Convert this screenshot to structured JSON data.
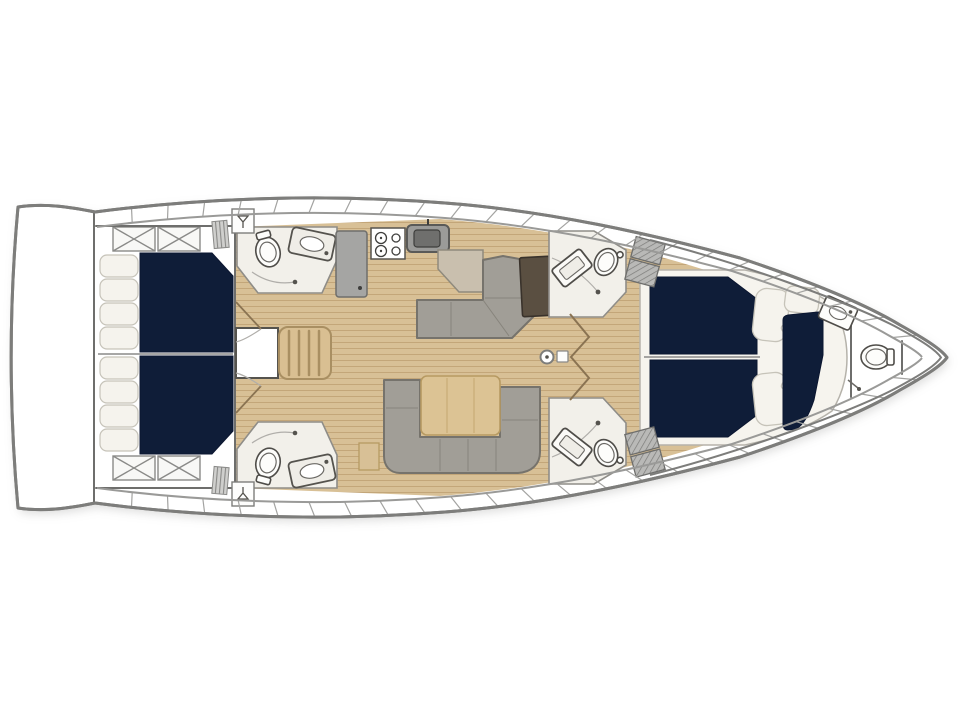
{
  "diagram": {
    "type": "yacht-interior-floor-plan",
    "orientation": "bow-right",
    "rooms": [
      "swim-platform",
      "aft-cabin-port",
      "aft-cabin-starboard",
      "aft-head-port",
      "aft-head-starboard",
      "galley",
      "salon",
      "dinette",
      "nav-station",
      "mid-head-port",
      "mid-head-starboard",
      "forward-owner-cabin",
      "forward-single-berth",
      "bow-head"
    ],
    "fixtures": [
      {
        "name": "double-berth",
        "count": 4
      },
      {
        "name": "single-berth",
        "count": 1
      },
      {
        "name": "toilet",
        "count": 5
      },
      {
        "name": "washbasin",
        "count": 5
      },
      {
        "name": "shower-head",
        "count": 3
      },
      {
        "name": "deck-hatch-x",
        "count": 4
      },
      {
        "name": "companionway-stairs",
        "count": 1
      },
      {
        "name": "dinette-table",
        "count": 1
      },
      {
        "name": "chart-table",
        "count": 1
      },
      {
        "name": "l-sofa",
        "count": 1
      },
      {
        "name": "u-sofa",
        "count": 1
      },
      {
        "name": "galley-stove",
        "count": 1
      },
      {
        "name": "galley-sink",
        "count": 1
      },
      {
        "name": "refrigerator",
        "count": 1
      },
      {
        "name": "mast",
        "count": 1
      },
      {
        "name": "pillow",
        "count": 11
      }
    ]
  },
  "colors": {
    "hull_line": "#7d7d7b",
    "inner_line": "#9a9a98",
    "floor_wood": "#d8c096",
    "floor_wood_stripe": "#c3a679",
    "mattress_navy": "#0f1d38",
    "pillow": "#f5f3ed",
    "platform": "#f6f4ee",
    "head_floor": "#f2f0ea",
    "sofa_gray": "#a19e97",
    "furniture_gray": "#a5a5a3",
    "appliance_gray": "#9b9b99",
    "chart_table_brown": "#5a4f41",
    "table_wood": "#dcc394",
    "stairs_wood": "#d9bf92",
    "counter_tan": "#c9bfae",
    "hatch_gray": "#b9b9b7",
    "white": "#ffffff"
  }
}
